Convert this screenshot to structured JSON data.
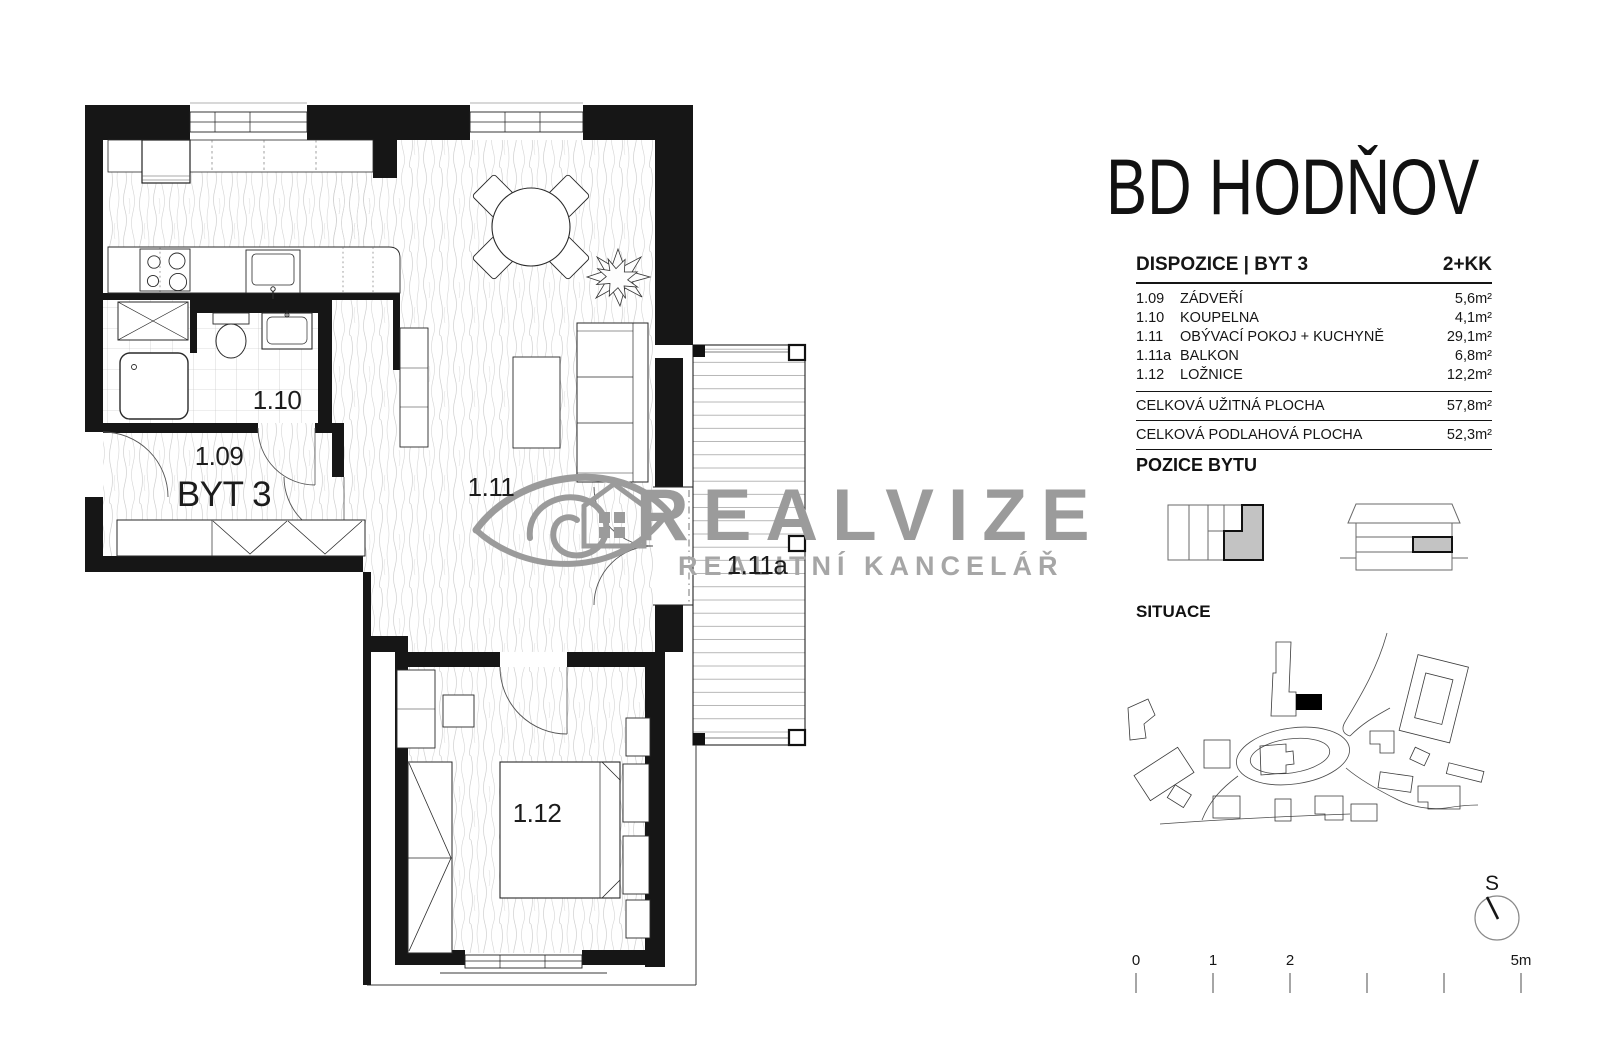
{
  "title": "BD HODŇOV",
  "watermark": {
    "brand": "REALVIZE",
    "subtitle": "REALITNÍ KANCELÁŘ"
  },
  "plan": {
    "labels": {
      "entry_code": "1.09",
      "apartment": "BYT 3",
      "bathroom": "1.10",
      "living": "1.11",
      "balcony": "1.11a",
      "bedroom": "1.12"
    }
  },
  "dispozice": {
    "heading": "DISPOZICE | BYT 3",
    "type": "2+KK",
    "rows": [
      {
        "code": "1.09",
        "name": "ZÁDVEŘÍ",
        "area": "5,6m²"
      },
      {
        "code": "1.10",
        "name": "KOUPELNA",
        "area": "4,1m²"
      },
      {
        "code": "1.11",
        "name": "OBÝVACÍ POKOJ + KUCHYNĚ",
        "area": "29,1m²"
      },
      {
        "code": "1.11a",
        "name": "BALKON",
        "area": "6,8m²"
      },
      {
        "code": "1.12",
        "name": "LOŽNICE",
        "area": "12,2m²"
      }
    ],
    "totals": [
      {
        "name": "CELKOVÁ UŽITNÁ PLOCHA",
        "area": "57,8m²"
      },
      {
        "name": "CELKOVÁ PODLAHOVÁ PLOCHA",
        "area": "52,3m²"
      }
    ]
  },
  "pozice": {
    "heading": "POZICE BYTU"
  },
  "situace": {
    "heading": "SITUACE"
  },
  "compass": {
    "label": "S"
  },
  "scalebar": {
    "labels": [
      "0",
      "1",
      "2",
      "5m"
    ]
  }
}
